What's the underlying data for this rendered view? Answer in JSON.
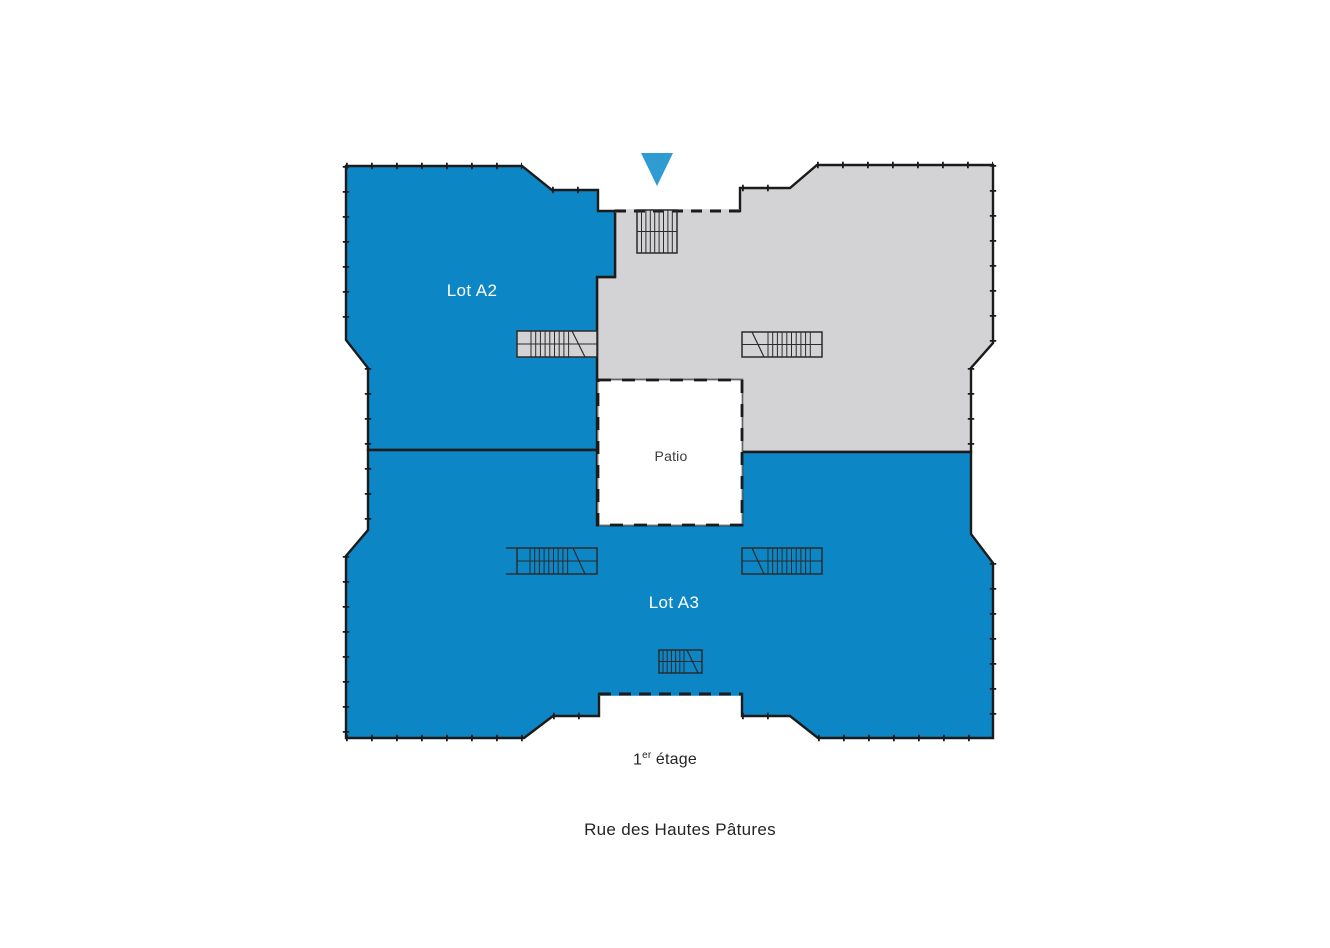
{
  "plan": {
    "lots": {
      "a2": {
        "label": "Lot A2"
      },
      "a3": {
        "label": "Lot A3"
      }
    },
    "patio": {
      "label": "Patio"
    },
    "floor_caption": {
      "number": "1",
      "ordinal_suffix": "er",
      "word": "étage"
    },
    "street_caption": "Rue des Hautes Pâtures",
    "icons": {
      "entrance_marker": "triangle-down"
    },
    "colors": {
      "lot_fill": "#0d86c6",
      "common_fill": "#d3d3d5",
      "patio_fill": "#ffffff",
      "outline": "#1b1b1b",
      "stair_lines": "#2b2b2b",
      "marker": "#2e9bd3",
      "lot_label_text": "#ffffff",
      "patio_label_text": "#3b3b3b",
      "caption_text": "#242424"
    }
  }
}
